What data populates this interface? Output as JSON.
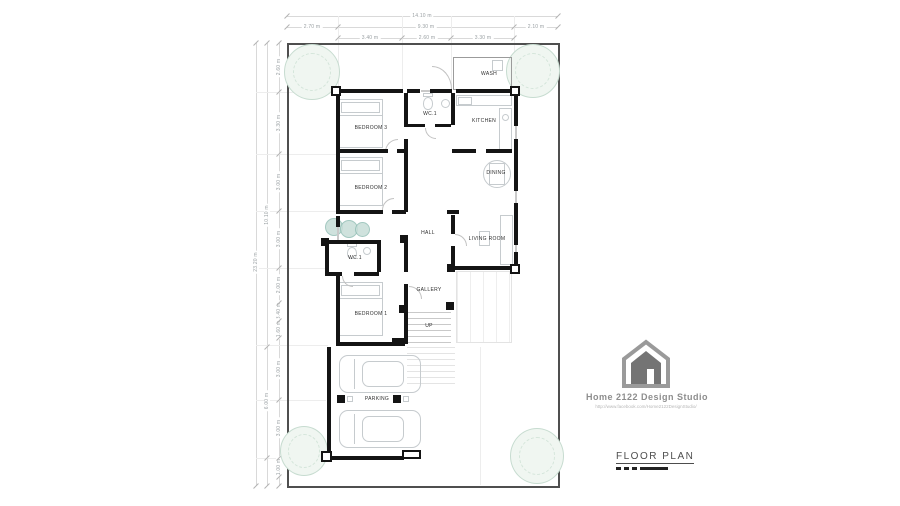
{
  "plan": {
    "rooms": [
      {
        "name": "WASH",
        "x": 489,
        "y": 74
      },
      {
        "name": "BEDROOM 3",
        "x": 371,
        "y": 128
      },
      {
        "name": "WC.1",
        "x": 430,
        "y": 114
      },
      {
        "name": "KITCHEN",
        "x": 484,
        "y": 121
      },
      {
        "name": "BEDROOM 2",
        "x": 371,
        "y": 188
      },
      {
        "name": "DINING",
        "x": 496,
        "y": 173
      },
      {
        "name": "HALL",
        "x": 428,
        "y": 233
      },
      {
        "name": "LIVING ROOM",
        "x": 487,
        "y": 239
      },
      {
        "name": "WC.1",
        "x": 355,
        "y": 258
      },
      {
        "name": "GALLERY",
        "x": 429,
        "y": 290
      },
      {
        "name": "BEDROOM 1",
        "x": 371,
        "y": 314
      },
      {
        "name": "UP",
        "x": 429,
        "y": 326
      },
      {
        "name": "PARKING",
        "x": 377,
        "y": 399
      }
    ]
  },
  "dimensions": {
    "top": {
      "total": "14.10 m",
      "row2": [
        "2.70 m",
        "9.30 m",
        "2.10 m"
      ],
      "row3": [
        "3.40 m",
        "2.60 m",
        "3.30 m"
      ]
    },
    "left": {
      "total": "23.20 m",
      "mid": [
        "10.10 m",
        "6.00 m"
      ],
      "inner": [
        "2.60 m",
        "3.30 m",
        "3.00 m",
        "3.00 m",
        "2.00 m",
        "3.40 m",
        "1.60 m",
        "3.00 m",
        "3.00 m",
        "1.00 m"
      ]
    }
  },
  "title_block": {
    "studio_name": "Home 2122 Design Studio",
    "studio_url": "http://www.facebook.com/Home2122DesignStudio/",
    "drawing_title": "FLOOR PLAN"
  },
  "colors": {
    "wall": "#141414",
    "plot_border": "#4f4f4f",
    "furniture": "#c6cbce",
    "tree": "#cfe3d8",
    "accent_text": "#8d8d8d"
  }
}
